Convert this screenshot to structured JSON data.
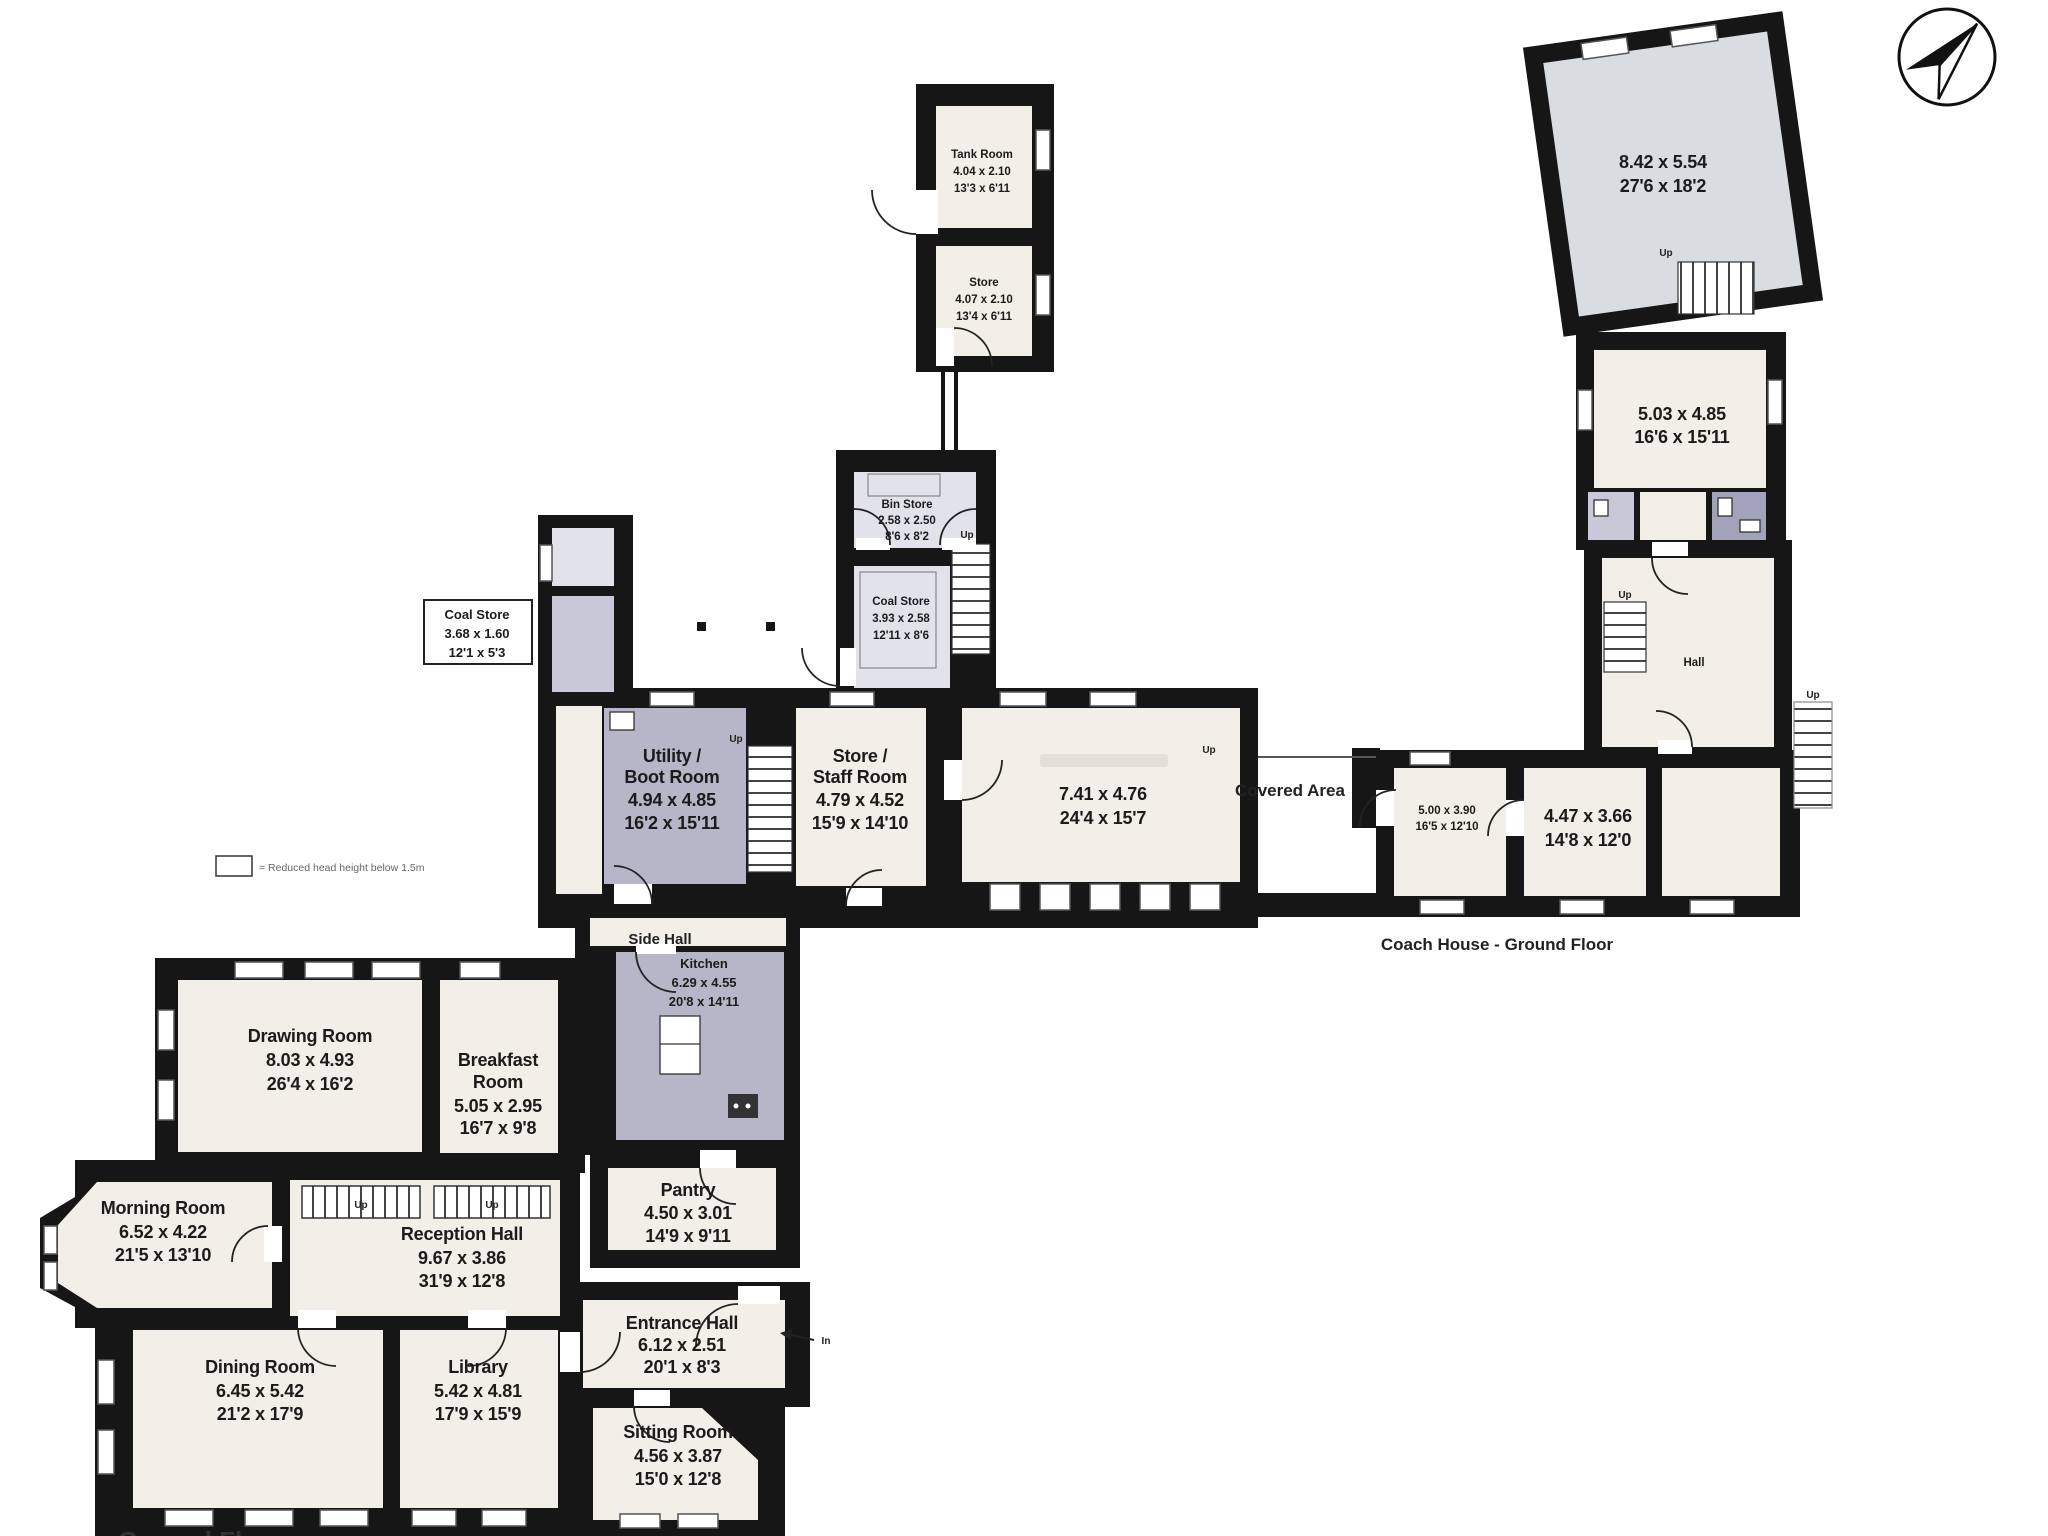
{
  "plan": {
    "captions": {
      "side_hall": "Side Hall",
      "covered_area": "Covered Area",
      "coach_house": "Coach House - Ground Floor",
      "ground_floor": "Ground Floor",
      "hall": "Hall",
      "up": "Up",
      "in": "In",
      "legend": "= Reduced head height below 1.5m"
    },
    "colors": {
      "wall": "#161616",
      "room_fill": "#f2efe8",
      "shaded_room_fill": "#b7b6c9",
      "shaded_light_fill": "#e2e2ea",
      "coach_room_fill": "#d9dde2",
      "bathroom_fill": "#a3a2bb"
    },
    "rooms": {
      "drawing_room": {
        "lines": [
          "Drawing Room",
          "8.03 x 4.93",
          "26'4 x 16'2"
        ]
      },
      "breakfast_room": {
        "lines": [
          "Breakfast",
          "Room",
          "5.05 x 2.95",
          "16'7 x 9'8"
        ]
      },
      "morning_room": {
        "lines": [
          "Morning Room",
          "6.52 x 4.22",
          "21'5 x 13'10"
        ]
      },
      "reception_hall": {
        "lines": [
          "Reception Hall",
          "9.67 x 3.86",
          "31'9 x 12'8"
        ]
      },
      "dining_room": {
        "lines": [
          "Dining Room",
          "6.45 x 5.42",
          "21'2 x 17'9"
        ]
      },
      "library": {
        "lines": [
          "Library",
          "5.42 x 4.81",
          "17'9 x 15'9"
        ]
      },
      "entrance_hall": {
        "lines": [
          "Entrance Hall",
          "6.12 x 2.51",
          "20'1 x 8'3"
        ]
      },
      "sitting_room": {
        "lines": [
          "Sitting Room",
          "4.56 x 3.87",
          "15'0 x 12'8"
        ]
      },
      "pantry": {
        "lines": [
          "Pantry",
          "4.50 x 3.01",
          "14'9 x 9'11"
        ]
      },
      "kitchen": {
        "lines": [
          "Kitchen",
          "6.29 x 4.55",
          "20'8 x 14'11"
        ]
      },
      "utility_boot": {
        "lines": [
          "Utility /",
          "Boot Room",
          "4.94 x 4.85",
          "16'2 x 15'11"
        ]
      },
      "store_staff": {
        "lines": [
          "Store /",
          "Staff Room",
          "4.79 x 4.52",
          "15'9 x 14'10"
        ]
      },
      "big_room": {
        "lines": [
          "7.41 x 4.76",
          "24'4 x 15'7"
        ]
      },
      "coal_callout": {
        "lines": [
          "Coal Store",
          "3.68 x 1.60",
          "12'1 x 5'3"
        ]
      },
      "bin_store": {
        "lines": [
          "Bin Store",
          "2.58 x 2.50",
          "8'6 x 8'2"
        ]
      },
      "coal_store": {
        "lines": [
          "Coal Store",
          "3.93 x 2.58",
          "12'11 x 8'6"
        ]
      },
      "tank_room": {
        "lines": [
          "Tank Room",
          "4.04 x 2.10",
          "13'3 x 6'11"
        ]
      },
      "tank_store": {
        "lines": [
          "Store",
          "4.07 x 2.10",
          "13'4 x 6'11"
        ]
      },
      "coach_big": {
        "lines": [
          "8.42 x 5.54",
          "27'6 x 18'2"
        ]
      },
      "coach_mid": {
        "lines": [
          "5.03 x 4.85",
          "16'6 x 15'11"
        ]
      },
      "coach_small": {
        "lines": [
          "5.00 x 3.90",
          "16'5 x 12'10"
        ]
      },
      "coach_right": {
        "lines": [
          "4.47 x 3.66",
          "14'8 x 12'0"
        ]
      }
    }
  }
}
